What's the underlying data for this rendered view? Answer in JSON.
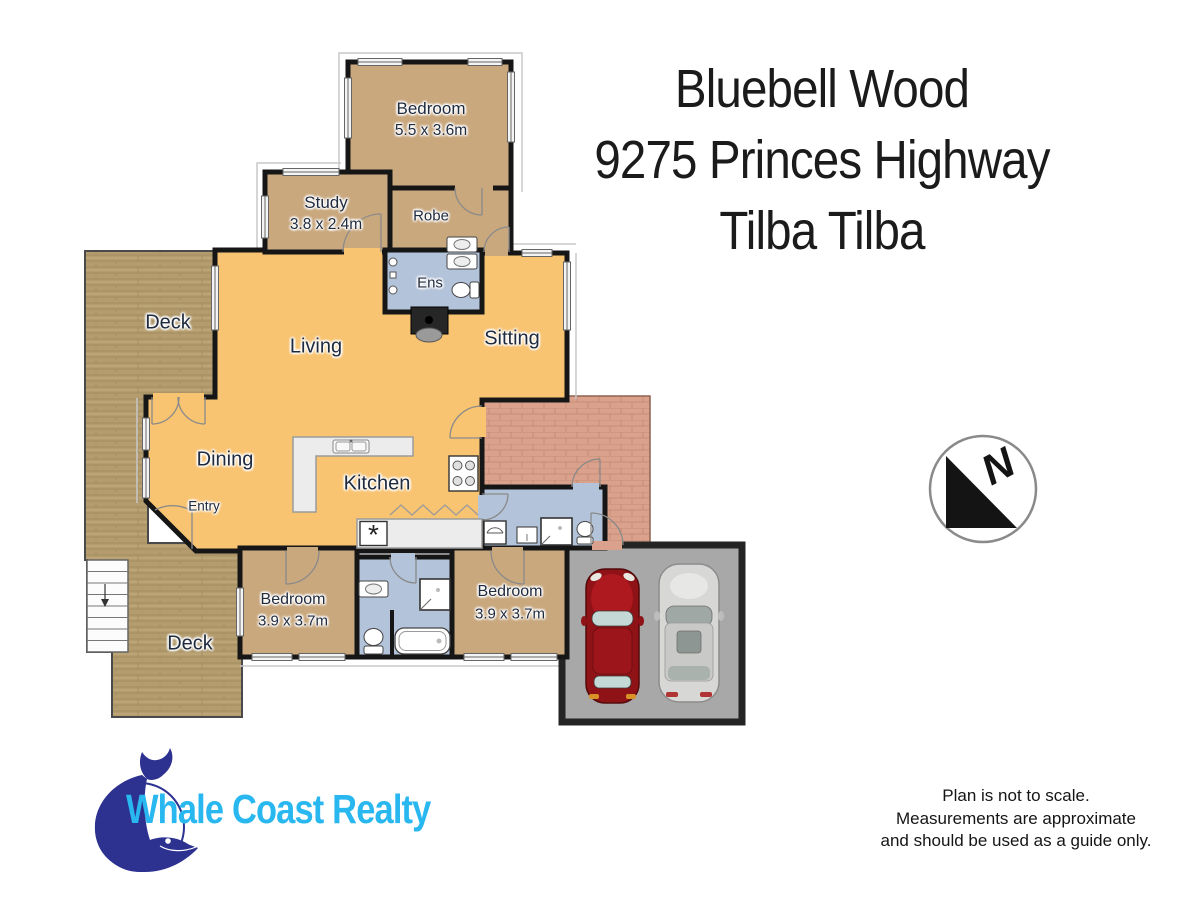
{
  "title": {
    "line1": "Bluebell Wood",
    "line2": "9275 Princes Highway",
    "line3": "Tilba Tilba"
  },
  "plan": {
    "rooms": {
      "deck_top": {
        "label": "Deck"
      },
      "bedroom_top": {
        "label": "Bedroom",
        "dims": "5.5 x 3.6m"
      },
      "study": {
        "label": "Study",
        "dims": "3.8 x 2.4m"
      },
      "robe": {
        "label": "Robe"
      },
      "ens": {
        "label": "Ens"
      },
      "living": {
        "label": "Living"
      },
      "sitting": {
        "label": "Sitting"
      },
      "dining": {
        "label": "Dining"
      },
      "entry": {
        "label": "Entry"
      },
      "kitchen": {
        "label": "Kitchen"
      },
      "bedroom_left": {
        "label": "Bedroom",
        "dims": "3.9 x 3.7m"
      },
      "bedroom_right": {
        "label": "Bedroom",
        "dims": "3.9 x 3.7m"
      },
      "deck_bottom": {
        "label": "Deck"
      }
    },
    "compass": {
      "north": "N"
    },
    "icons": {
      "dishwasher": "*"
    }
  },
  "footer": {
    "logo_text": "Whale Coast Realty",
    "disclaimer_line1": "Plan is not to scale.",
    "disclaimer_line2": "Measurements are approximate",
    "disclaimer_line3": "and should be used as a guide only."
  },
  "colors": {
    "wall": "#161616",
    "floor_main": "#f8c472",
    "floor_bedroom": "#c9a87e",
    "deck_wood": "#b49c6f",
    "patio_brick": "#daa28c",
    "wet_area": "#b3c3da",
    "garage_floor": "#a8a8a8",
    "logo_whale": "#2d3190",
    "logo_text": "#29b7f0",
    "car_red": "#8e1216",
    "car_silver": "#d7d7d5"
  }
}
